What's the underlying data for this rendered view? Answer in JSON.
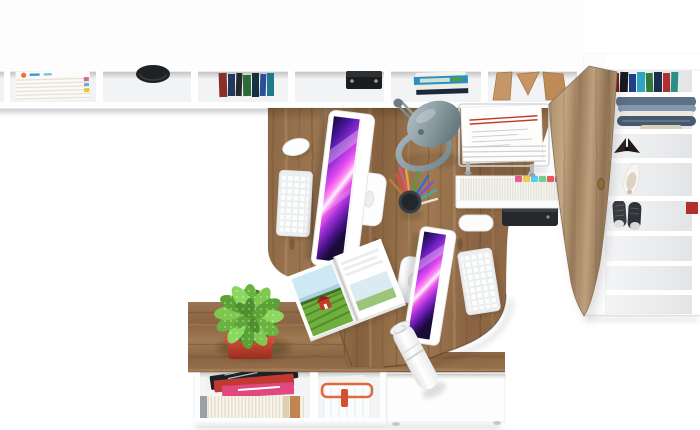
{
  "scene": {
    "description": "Top-down 3D render of a white and oak home-office furniture set: long wall shelf with books and decor, two-person desk with twin monitors, tall storage wardrobe with open weathered-wood doors, and a low sideboard with a spotted succulent in a red pot",
    "view": "top-down product render",
    "background_color": "#ffffff"
  },
  "palette": {
    "oak_wood": "#96714c",
    "oak_wood_dark": "#7e5c3d",
    "oak_wood_light": "#a8835e",
    "door_wood": "#ab8e6b",
    "furniture_white": "#ffffff",
    "shelf_interior": "#f2f3f4",
    "screen_magenta": "#e44cf0",
    "screen_deep_purple": "#1a0c38",
    "lamp_gray_blue": "#7c929c",
    "plant_green": "#6ab33f",
    "pot_red": "#d1503a",
    "basket_orange": "#e06a3d",
    "denim_blue": "#5d7186",
    "magazine_red": "#c13a32",
    "magazine_pink": "#e0487e",
    "speaker_black": "#1a1c1e",
    "paper_accent_red": "#c0392b"
  },
  "objects": {
    "wall_shelf": [
      "stacked-magazines",
      "black-bowl",
      "book-row",
      "black-speaker-box",
      "stacked-books",
      "wooden-bookends"
    ],
    "wardrobe": [
      "book-row",
      "folded-jeans",
      "dark-bow",
      "white-heeled-shoe",
      "dark-sneakers",
      "open-wood-door",
      "red-box"
    ],
    "desk": [
      "imac-monitor-1",
      "imac-monitor-2",
      "white-keyboard-1",
      "white-keyboard-2",
      "white-mouse",
      "gray-dome-lamp",
      "pencil-cup-with-pencils",
      "wire-document-tray",
      "file-drawer-with-color-tabs",
      "black-printer",
      "open-travel-magazine",
      "rolled-paper",
      "cable-grommet"
    ],
    "sideboard": [
      "spotted-succulent-in-red-pot",
      "magazine-pile",
      "paperback-books",
      "white-basket-orange-rim",
      "white-drawer-unit"
    ]
  }
}
